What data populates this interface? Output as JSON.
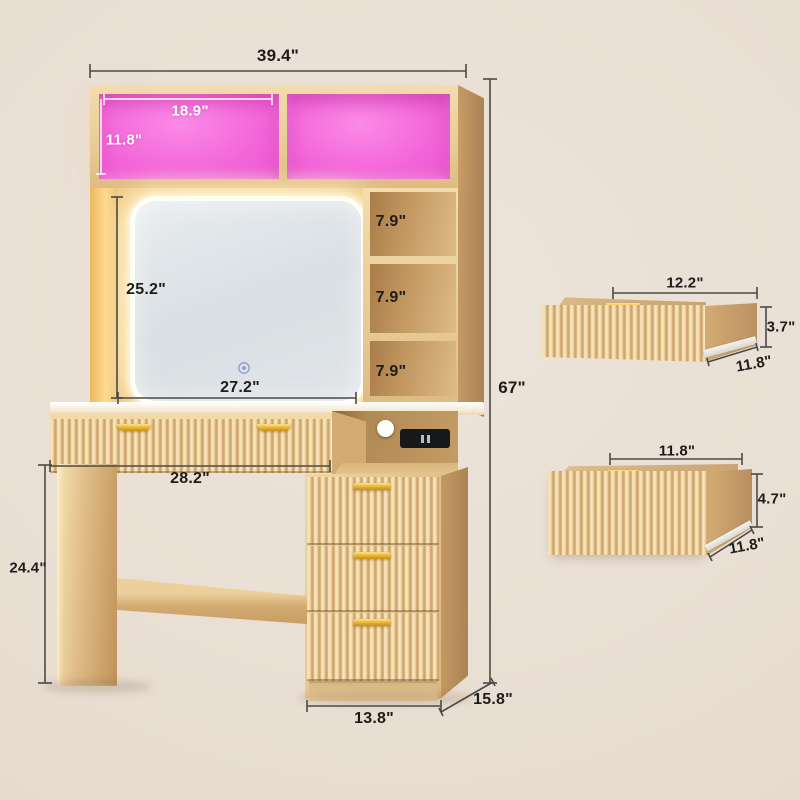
{
  "diagram_type": "furniture dimension diagram",
  "colors": {
    "background": "#e9ded2",
    "led_pink": "#f263d8",
    "wood_light": "#ecd2a0",
    "wood_dark": "#ab8456",
    "gold_accent": "#e2ac2c",
    "dimension_line": "#4a4a47",
    "dimension_text": "#1e1c1a",
    "dimension_text_on_pink": "#ffffff",
    "mirror_surface": "#dde2e6",
    "led_ring": "#fffef6"
  },
  "vanity": {
    "overall_width": "39.4\"",
    "overall_height": "67\"",
    "hutch": {
      "cubby_width": "18.9\"",
      "cubby_height": "11.8\""
    },
    "mirror": {
      "height": "25.2\"",
      "width": "27.2\""
    },
    "side_shelves": [
      "7.9\"",
      "7.9\"",
      "7.9\""
    ],
    "desktop_width": "28.2\"",
    "leg_height": "24.4\"",
    "cabinet_width": "13.8\"",
    "depth": "15.8\""
  },
  "drawer_details": {
    "top_drawer": {
      "width": "12.2\"",
      "height": "3.7\"",
      "depth": "11.8\""
    },
    "bottom_drawer": {
      "width": "11.8\"",
      "height": "4.7\"",
      "depth": "11.8\""
    }
  },
  "features": {
    "mirror_touch_sensor": "touch-control",
    "charging": "wireless-pad-and-usb-power-strip"
  }
}
